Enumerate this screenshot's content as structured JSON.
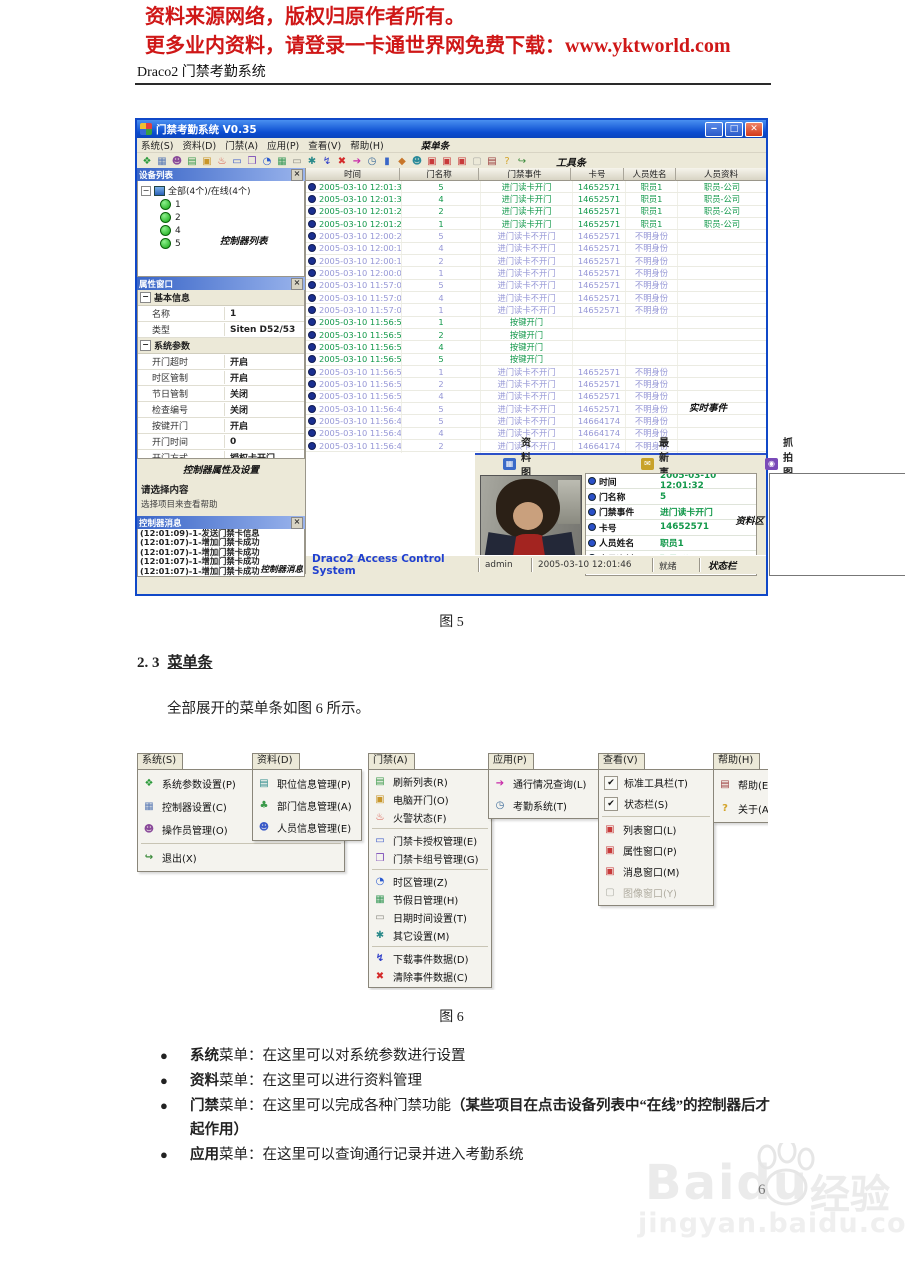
{
  "doc": {
    "header1": "资料来源网络，版权归原作者所有。",
    "header2": "更多业内资料，请登录一卡通世界网免费下载：www.yktworld.com",
    "title": "Draco2 门禁考勤系统",
    "fig5_caption": "图 5",
    "section_num": "2. 3",
    "section_title": "菜单条",
    "paragraph": "全部展开的菜单条如图 6 所示。",
    "fig6_caption": "图 6",
    "page_number": "6"
  },
  "watermark": {
    "brand": "Baidu",
    "cn": "经验",
    "url": "jingyan.baidu.com"
  },
  "app": {
    "title": "门禁考勤系统 V0.35",
    "anno_menubar": "菜单条",
    "anno_toolbar": "工具条",
    "menubar_items": [
      "系统(S)",
      "资料(D)",
      "门禁(A)",
      "应用(P)",
      "查看(V)",
      "帮助(H)"
    ],
    "toolbar_icons": [
      {
        "name": "connect-icon",
        "g": "❖",
        "c": "#2a9a3a"
      },
      {
        "name": "controller-icon",
        "g": "▦",
        "c": "#5b7bb5"
      },
      {
        "name": "operator-icon",
        "g": "☻",
        "c": "#8a4a9a"
      },
      {
        "name": "refresh-icon",
        "g": "▤",
        "c": "#3a9a4a"
      },
      {
        "name": "open-door-icon",
        "g": "▣",
        "c": "#c8962a"
      },
      {
        "name": "fire-icon",
        "g": "♨",
        "c": "#d43a2a"
      },
      {
        "name": "card-auth-icon",
        "g": "▭",
        "c": "#3a5ac8"
      },
      {
        "name": "card-group-icon",
        "g": "❒",
        "c": "#7a4ab8"
      },
      {
        "name": "timezone-icon",
        "g": "◔",
        "c": "#2a5ad0"
      },
      {
        "name": "holiday-icon",
        "g": "▦",
        "c": "#3a9a5a"
      },
      {
        "name": "datetime-icon",
        "g": "▭",
        "c": "#8a8a82"
      },
      {
        "name": "settings-icon",
        "g": "✱",
        "c": "#2a8a8a"
      },
      {
        "name": "download-icon",
        "g": "↯",
        "c": "#2a3ac8"
      },
      {
        "name": "clear-icon",
        "g": "✖",
        "c": "#d42a2a"
      },
      {
        "name": "query-icon",
        "g": "➔",
        "c": "#c82aa8"
      },
      {
        "name": "attendance-icon",
        "g": "◷",
        "c": "#3a6a9a"
      },
      {
        "name": "lock-icon",
        "g": "▮",
        "c": "#3a66c8"
      },
      {
        "name": "key-icon",
        "g": "◆",
        "c": "#c8762a"
      },
      {
        "name": "people-icon",
        "g": "☻",
        "c": "#2a8a9a"
      },
      {
        "name": "list-window-icon",
        "g": "▣",
        "c": "#c83a3a"
      },
      {
        "name": "prop-window-icon",
        "g": "▣",
        "c": "#c83a3a"
      },
      {
        "name": "msg-window-icon",
        "g": "▣",
        "c": "#c83a3a"
      },
      {
        "name": "image-window-icon",
        "g": "▢",
        "c": "#b0b0a8"
      },
      {
        "name": "help-icon",
        "g": "▤",
        "c": "#9a3a3a"
      },
      {
        "name": "about-icon",
        "g": "?",
        "c": "#d4a42a"
      },
      {
        "name": "exit-icon",
        "g": "↪",
        "c": "#3a8a3a"
      }
    ],
    "device": {
      "title": "设备列表",
      "root": "全部(4个)/在线(4个)",
      "nodes": [
        "1",
        "2",
        "4",
        "5"
      ],
      "anno": "控制器列表"
    },
    "prop": {
      "title": "属性窗口",
      "anno": "控制器属性及设置",
      "sections": [
        {
          "name": "基本信息",
          "rows": [
            [
              "名称",
              "1"
            ],
            [
              "类型",
              "Siten D52/53"
            ]
          ]
        },
        {
          "name": "系统参数",
          "rows": [
            [
              "开门超时",
              "开启"
            ],
            [
              "时区管制",
              "开启"
            ],
            [
              "节日管制",
              "关闭"
            ],
            [
              "检查编号",
              "关闭"
            ],
            [
              "按键开门",
              "开启"
            ],
            [
              "开门时间",
              "0"
            ],
            [
              "开门方式",
              "授权卡开门"
            ]
          ]
        }
      ]
    },
    "hint": {
      "title": "请选择内容",
      "text": "选择项目来查看帮助"
    },
    "msg": {
      "title": "控制器消息",
      "anno": "控制器消息",
      "items": [
        "(12:01:09)-1-发送门禁卡信息",
        "(12:01:07)-1-增加门禁卡成功",
        "(12:01:07)-1-增加门禁卡成功",
        "(12:01:07)-1-增加门禁卡成功",
        "(12:01:07)-1-增加门禁卡成功"
      ]
    },
    "table": {
      "anno": "实时事件",
      "columns": [
        "时间",
        "门名称",
        "门禁事件",
        "卡号",
        "人员姓名",
        "人员资料"
      ],
      "rows": [
        {
          "t": "2005-03-10 12:01:32",
          "d": "5",
          "e": "进门读卡开门",
          "c": "14652571",
          "n": "职员1",
          "i": "职员-公司",
          "k": "g"
        },
        {
          "t": "2005-03-10 12:01:30",
          "d": "4",
          "e": "进门读卡开门",
          "c": "14652571",
          "n": "职员1",
          "i": "职员-公司",
          "k": "g"
        },
        {
          "t": "2005-03-10 12:01:27",
          "d": "2",
          "e": "进门读卡开门",
          "c": "14652571",
          "n": "职员1",
          "i": "职员-公司",
          "k": "g"
        },
        {
          "t": "2005-03-10 12:01:21",
          "d": "1",
          "e": "进门读卡开门",
          "c": "14652571",
          "n": "职员1",
          "i": "职员-公司",
          "k": "g"
        },
        {
          "t": "2005-03-10 12:00:22",
          "d": "5",
          "e": "进门读卡不开门",
          "c": "14652571",
          "n": "不明身份",
          "i": "",
          "k": "p"
        },
        {
          "t": "2005-03-10 12:00:19",
          "d": "4",
          "e": "进门读卡不开门",
          "c": "14652571",
          "n": "不明身份",
          "i": "",
          "k": "p"
        },
        {
          "t": "2005-03-10 12:00:13",
          "d": "2",
          "e": "进门读卡不开门",
          "c": "14652571",
          "n": "不明身份",
          "i": "",
          "k": "p"
        },
        {
          "t": "2005-03-10 12:00:08",
          "d": "1",
          "e": "进门读卡不开门",
          "c": "14652571",
          "n": "不明身份",
          "i": "",
          "k": "p"
        },
        {
          "t": "2005-03-10 11:57:05",
          "d": "5",
          "e": "进门读卡不开门",
          "c": "14652571",
          "n": "不明身份",
          "i": "",
          "k": "p"
        },
        {
          "t": "2005-03-10 11:57:04",
          "d": "4",
          "e": "进门读卡不开门",
          "c": "14652571",
          "n": "不明身份",
          "i": "",
          "k": "p"
        },
        {
          "t": "2005-03-10 11:57:01",
          "d": "1",
          "e": "进门读卡不开门",
          "c": "14652571",
          "n": "不明身份",
          "i": "",
          "k": "p"
        },
        {
          "t": "2005-03-10 11:56:58",
          "d": "1",
          "e": "按键开门",
          "c": "",
          "n": "",
          "i": "",
          "k": "g"
        },
        {
          "t": "2005-03-10 11:56:58",
          "d": "2",
          "e": "按键开门",
          "c": "",
          "n": "",
          "i": "",
          "k": "g"
        },
        {
          "t": "2005-03-10 11:56:58",
          "d": "4",
          "e": "按键开门",
          "c": "",
          "n": "",
          "i": "",
          "k": "g"
        },
        {
          "t": "2005-03-10 11:56:56",
          "d": "5",
          "e": "按键开门",
          "c": "",
          "n": "",
          "i": "",
          "k": "g"
        },
        {
          "t": "2005-03-10 11:56:52",
          "d": "1",
          "e": "进门读卡不开门",
          "c": "14652571",
          "n": "不明身份",
          "i": "",
          "k": "p"
        },
        {
          "t": "2005-03-10 11:56:52",
          "d": "2",
          "e": "进门读卡不开门",
          "c": "14652571",
          "n": "不明身份",
          "i": "",
          "k": "p"
        },
        {
          "t": "2005-03-10 11:56:50",
          "d": "4",
          "e": "进门读卡不开门",
          "c": "14652571",
          "n": "不明身份",
          "i": "",
          "k": "p"
        },
        {
          "t": "2005-03-10 11:56:49",
          "d": "5",
          "e": "进门读卡不开门",
          "c": "14652571",
          "n": "不明身份",
          "i": "",
          "k": "p"
        },
        {
          "t": "2005-03-10 11:56:46",
          "d": "5",
          "e": "进门读卡不开门",
          "c": "14664174",
          "n": "不明身份",
          "i": "",
          "k": "p"
        },
        {
          "t": "2005-03-10 11:56:42",
          "d": "4",
          "e": "进门读卡不开门",
          "c": "14664174",
          "n": "不明身份",
          "i": "",
          "k": "p"
        },
        {
          "t": "2005-03-10 11:56:40",
          "d": "2",
          "e": "进门读卡不开门",
          "c": "14664174",
          "n": "不明身份",
          "i": "",
          "k": "p"
        },
        {
          "t": "2005-03-10 11:56:38",
          "d": "2",
          "e": "进门读卡不开门",
          "c": "14664174",
          "n": "不明身份",
          "i": "",
          "k": "p"
        },
        {
          "t": "2005-03-10 11:56:36",
          "d": "1",
          "e": "进门读卡不开门",
          "c": "14664174",
          "n": "不明身份",
          "i": "",
          "k": "p"
        }
      ]
    },
    "bottom": {
      "photo_title": "资料图片",
      "event_title": "最新事件",
      "snap_title": "抓拍图片",
      "anno": "资料区",
      "details": [
        [
          "时间",
          "2005-03-10 12:01:32"
        ],
        [
          "门名称",
          "5"
        ],
        [
          "门禁事件",
          "进门读卡开门"
        ],
        [
          "卡号",
          "14652571"
        ],
        [
          "人员姓名",
          "职员1"
        ],
        [
          "人员资料",
          "职员-公司"
        ]
      ]
    },
    "status": {
      "brand": "Draco2 Access Control System",
      "user": "admin",
      "time": "2005-03-10 12:01:46",
      "ready": "就绪",
      "anno": "状态栏"
    }
  },
  "menus": [
    {
      "label": "系统(S)",
      "x": 2,
      "w": 206,
      "ih": 23,
      "items": [
        {
          "g": "❖",
          "c": "#2a9a3a",
          "t": "系统参数设置(P)",
          "icon": "system-params-icon"
        },
        {
          "g": "▦",
          "c": "#5b7bb5",
          "t": "控制器设置(C)",
          "icon": "controller-settings-icon"
        },
        {
          "g": "☻",
          "c": "#8a4a9a",
          "t": "操作员管理(O)",
          "icon": "operator-manage-icon"
        },
        {
          "sep": true
        },
        {
          "g": "↪",
          "c": "#3a8a3a",
          "t": "退出(X)",
          "icon": "exit-icon"
        }
      ]
    },
    {
      "label": "资料(D)",
      "x": 117,
      "w": 108,
      "ih": 22,
      "items": [
        {
          "g": "▤",
          "c": "#2a8a8a",
          "t": "职位信息管理(P)",
          "icon": "position-info-icon"
        },
        {
          "g": "♣",
          "c": "#3a9a4a",
          "t": "部门信息管理(A)",
          "icon": "department-info-icon"
        },
        {
          "g": "☻",
          "c": "#3a5ac8",
          "t": "人员信息管理(E)",
          "icon": "personnel-info-icon"
        }
      ]
    },
    {
      "label": "门禁(A)",
      "x": 233,
      "w": 122,
      "ih": 18,
      "items": [
        {
          "g": "▤",
          "c": "#3a9a4a",
          "t": "刷新列表(R)",
          "icon": "refresh-list-icon"
        },
        {
          "g": "▣",
          "c": "#c8962a",
          "t": "电脑开门(O)",
          "icon": "pc-open-door-icon"
        },
        {
          "g": "♨",
          "c": "#d43a2a",
          "t": "火警状态(F)",
          "icon": "fire-status-icon"
        },
        {
          "sep": true
        },
        {
          "g": "▭",
          "c": "#3a5ac8",
          "t": "门禁卡授权管理(E)",
          "icon": "card-auth-icon"
        },
        {
          "g": "❒",
          "c": "#7a4ab8",
          "t": "门禁卡组号管理(G)",
          "icon": "card-group-icon"
        },
        {
          "sep": true
        },
        {
          "g": "◔",
          "c": "#2a5ad0",
          "t": "时区管理(Z)",
          "icon": "timezone-icon"
        },
        {
          "g": "▦",
          "c": "#3a9a5a",
          "t": "节假日管理(H)",
          "icon": "holiday-icon"
        },
        {
          "g": "▭",
          "c": "#8a8a82",
          "t": "日期时间设置(T)",
          "icon": "datetime-icon"
        },
        {
          "g": "✱",
          "c": "#2a8a8a",
          "t": "其它设置(M)",
          "icon": "other-settings-icon"
        },
        {
          "sep": true
        },
        {
          "g": "↯",
          "c": "#2a3ac8",
          "t": "下载事件数据(D)",
          "icon": "download-events-icon"
        },
        {
          "g": "✖",
          "c": "#d42a2a",
          "t": "清除事件数据(C)",
          "icon": "clear-events-icon"
        }
      ]
    },
    {
      "label": "应用(P)",
      "x": 353,
      "w": 119,
      "ih": 22,
      "items": [
        {
          "g": "➔",
          "c": "#c82aa8",
          "t": "通行情况查询(L)",
          "icon": "pass-query-icon"
        },
        {
          "g": "◷",
          "c": "#3a6a9a",
          "t": "考勤系统(T)",
          "icon": "attendance-icon"
        }
      ]
    },
    {
      "label": "查看(V)",
      "x": 463,
      "w": 114,
      "ih": 21,
      "items": [
        {
          "chk": true,
          "t": "标准工具栏(T)",
          "icon": "check-icon"
        },
        {
          "chk": true,
          "t": "状态栏(S)",
          "icon": "check-icon"
        },
        {
          "sep": true
        },
        {
          "g": "▣",
          "c": "#c83a3a",
          "t": "列表窗口(L)",
          "icon": "list-window-icon"
        },
        {
          "g": "▣",
          "c": "#c83a3a",
          "t": "属性窗口(P)",
          "icon": "prop-window-icon"
        },
        {
          "g": "▣",
          "c": "#c83a3a",
          "t": "消息窗口(M)",
          "icon": "msg-window-icon"
        },
        {
          "g": "▢",
          "c": "#b0b0a8",
          "t": "图像窗口(Y)",
          "icon": "image-window-icon",
          "dis": true
        }
      ]
    },
    {
      "label": "帮助(H)",
      "x": 578,
      "w": 80,
      "ih": 24,
      "items": [
        {
          "g": "▤",
          "c": "#9a3a3a",
          "t": "帮助(E)",
          "icon": "help-book-icon"
        },
        {
          "g": "?",
          "c": "#d4a42a",
          "t": "关于(A)",
          "icon": "about-icon"
        }
      ]
    }
  ],
  "bullets": [
    {
      "b1": "系统",
      "t1": "菜单：在这里可以对系统参数进行设置",
      "b2": ""
    },
    {
      "b1": "资料",
      "t1": "菜单：在这里可以进行资料管理",
      "b2": ""
    },
    {
      "b1": "门禁",
      "t1": "菜单：在这里可以完成各种门禁功能",
      "b2": "（某些项目在点击设备列表中“在线”的控制器后才起作用）"
    },
    {
      "b1": "应用",
      "t1": "菜单：在这里可以查询通行记录并进入考勤系统",
      "b2": ""
    }
  ]
}
